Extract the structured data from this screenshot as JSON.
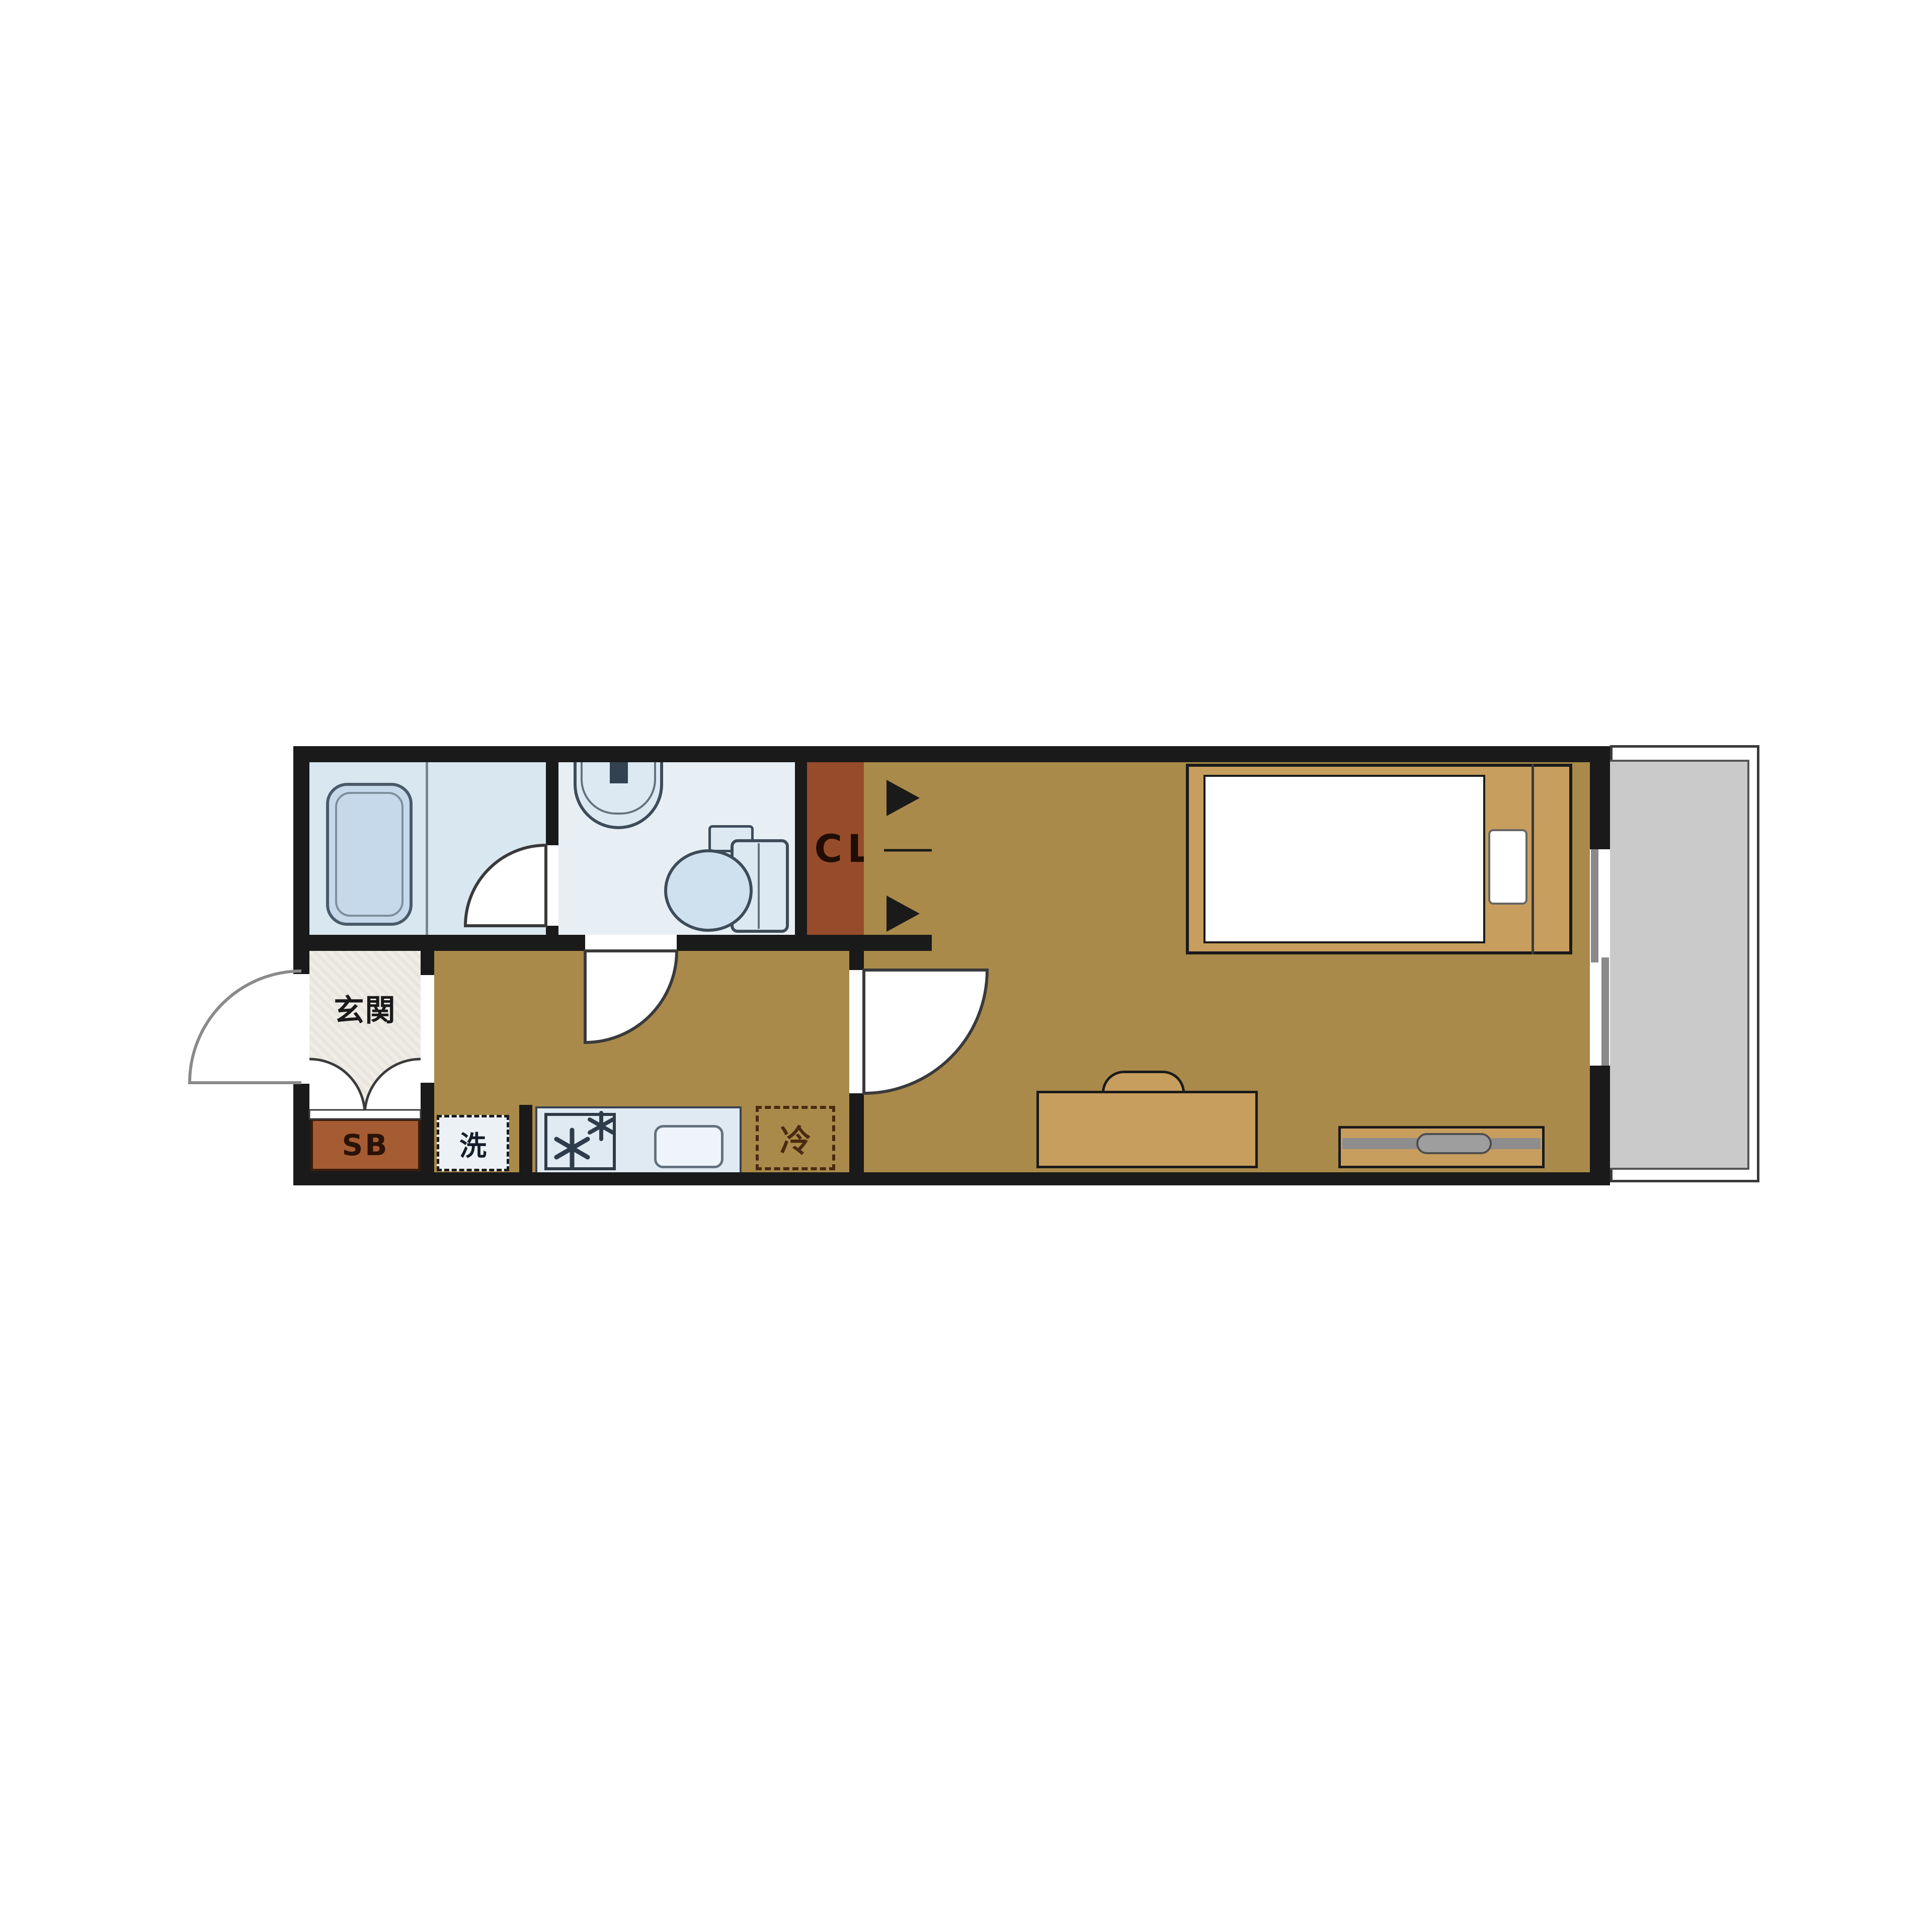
{
  "plan": {
    "type": "japanese-apartment-floorplan",
    "labels": {
      "entrance": "玄関",
      "shoe_box": "SB",
      "washer": "洗",
      "refrigerator": "冷",
      "closet": "CL"
    },
    "rooms": [
      {
        "name": "bathroom",
        "features": [
          "bathtub",
          "bath-door"
        ]
      },
      {
        "name": "washroom-toilet",
        "features": [
          "wash-basin",
          "toilet",
          "toilet-door"
        ]
      },
      {
        "name": "closet",
        "label": "CL",
        "features": [
          "bifold-doors"
        ]
      },
      {
        "name": "entrance-genkan",
        "label": "玄関",
        "features": [
          "entrance-door",
          "double-door-arcs",
          "shoe-box"
        ]
      },
      {
        "name": "hallway-kitchen",
        "features": [
          "washing-machine-pan",
          "kitchen-counter",
          "stove-burners",
          "kitchen-sink",
          "refrigerator-space",
          "door-to-main-room"
        ]
      },
      {
        "name": "main-room",
        "features": [
          "single-bed",
          "pillow",
          "desk-with-chair",
          "tv-board",
          "sliding-window"
        ]
      },
      {
        "name": "balcony",
        "features": []
      }
    ],
    "colors": {
      "wall": "#1a1a1a",
      "floor_tan": "#aa8a4a",
      "wet_room_blue": "#d9e7f0",
      "washroom_blue": "#e7eff5",
      "fixture_outline": "#3e4c5a",
      "closet_brown": "#964c2a",
      "shoe_box_brown": "#a55c32",
      "furniture_tan": "#c89e5f",
      "balcony_gray": "#cacaca",
      "entrance_floor": "#f0ede6",
      "tv_gray": "#8d8d8d",
      "door_arc": "#3a3a3a"
    }
  }
}
